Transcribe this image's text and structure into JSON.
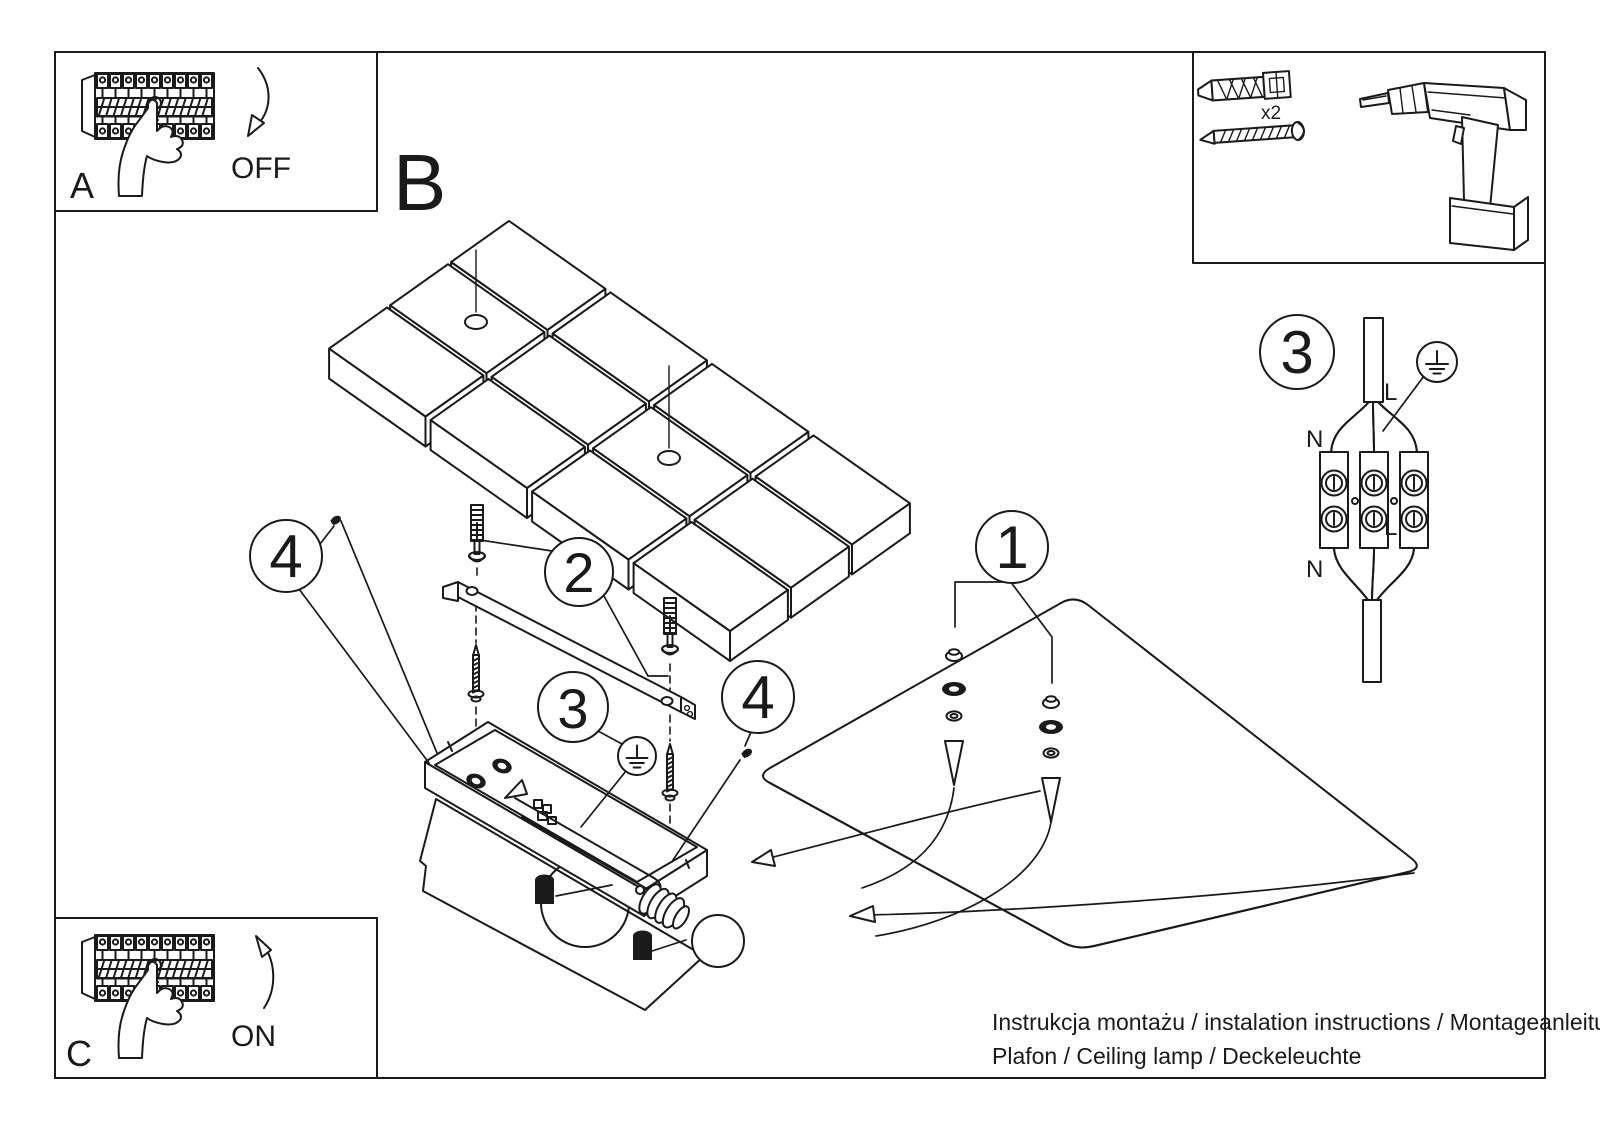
{
  "colors": {
    "background": "#ffffff",
    "line": "#1a1a1a"
  },
  "inset_a": {
    "label": "A",
    "state": "OFF"
  },
  "inset_c": {
    "label": "C",
    "state": "ON"
  },
  "section_b": {
    "label": "B"
  },
  "tools": {
    "anchor_quantity": "x2"
  },
  "steps": {
    "one": "1",
    "two": "2",
    "three": "3",
    "four": "4"
  },
  "wiring": {
    "n_top": "N",
    "n_bottom": "N",
    "l_top": "L",
    "l_bottom": "L"
  },
  "footer": {
    "line1": "Instrukcja montażu / instalation instructions / Montageanleitung",
    "line2": "Plafon / Ceiling lamp / Deckeleuchte"
  }
}
